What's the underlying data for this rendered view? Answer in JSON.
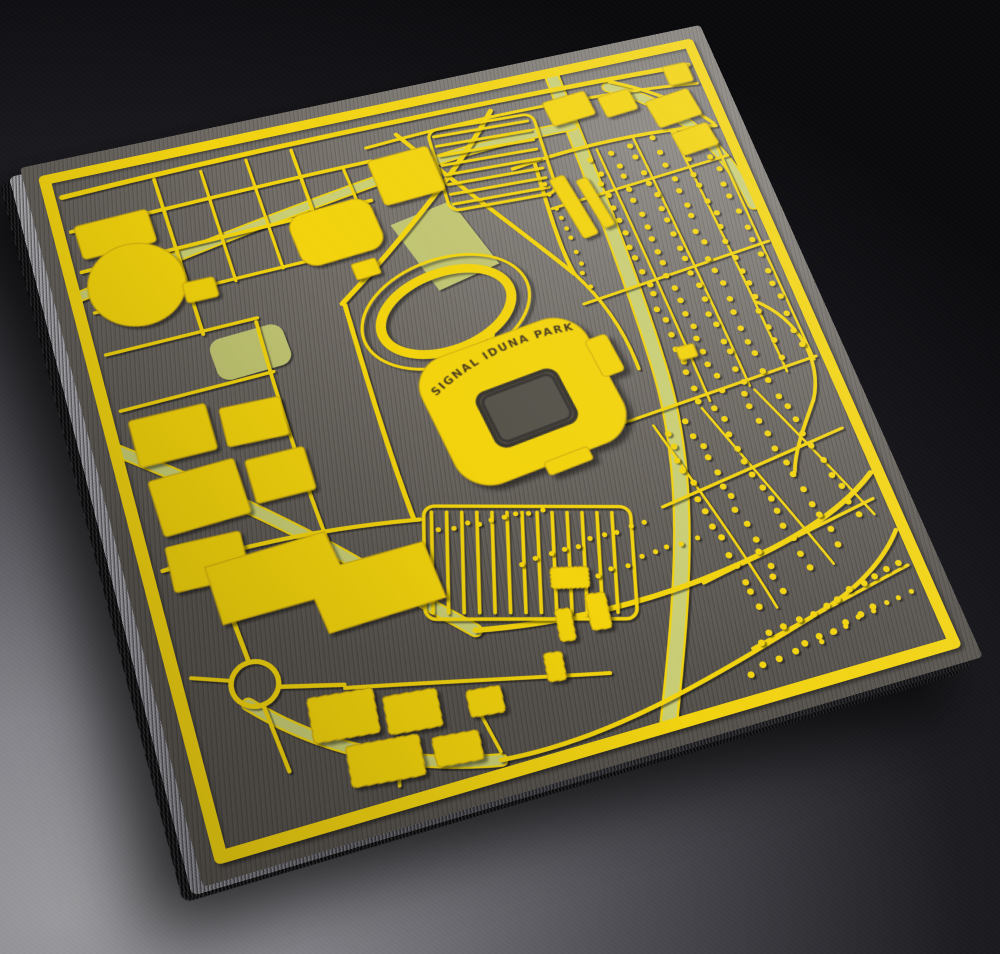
{
  "scene": {
    "subject": "3D-printed city map plaque of the Signal Iduna Park stadium district, black base with yellow streets and buildings, photographed at an angle on a gray surface",
    "stadium_label": "SIGNAL IDUNA PARK"
  },
  "colors": {
    "filament_yellow": "#F2D311",
    "filament_olive": "#C9CE74",
    "plate_surface": "#6E6962",
    "base_black": "#17171A",
    "backdrop_light": "#9A9A9E",
    "backdrop_dark": "#0A0A0D",
    "label_text": "#46391F"
  }
}
